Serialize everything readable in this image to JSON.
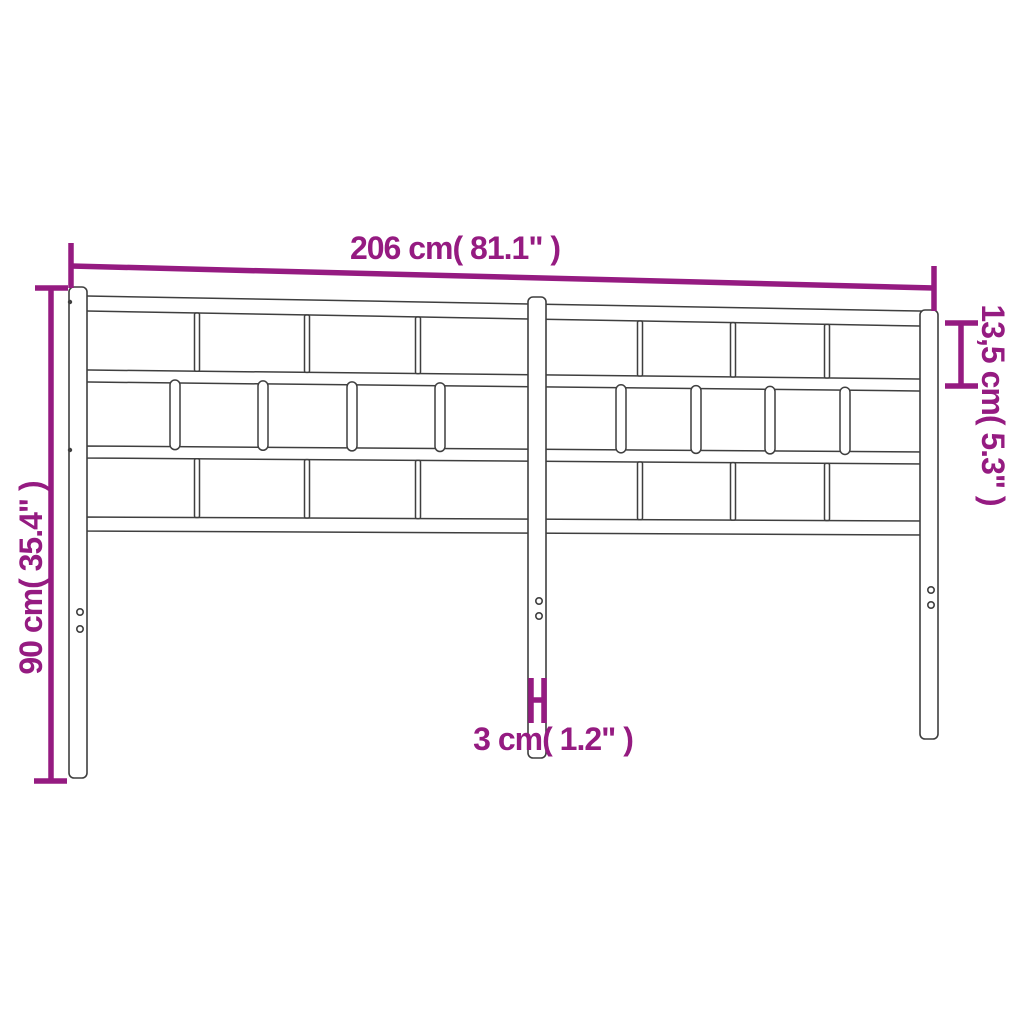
{
  "diagram": {
    "subject": "metal-headboard",
    "colors": {
      "background": "#ffffff",
      "outline": "#3f3f3f",
      "dimension": "#951b81"
    },
    "labels": {
      "width": "206 cm( 81.1\" )",
      "height": "90 cm( 35.4\" )",
      "top_section": "13,5 cm( 5.3\" )",
      "post_width": "3 cm( 1.2\" )"
    },
    "dimensions": [
      {
        "name": "overall-width",
        "cm": 206,
        "inches": 81.1
      },
      {
        "name": "overall-height",
        "cm": 90,
        "inches": 35.4
      },
      {
        "name": "top-section-height",
        "cm": 13.5,
        "inches": 5.3
      },
      {
        "name": "post-width",
        "cm": 3,
        "inches": 1.2
      }
    ]
  }
}
